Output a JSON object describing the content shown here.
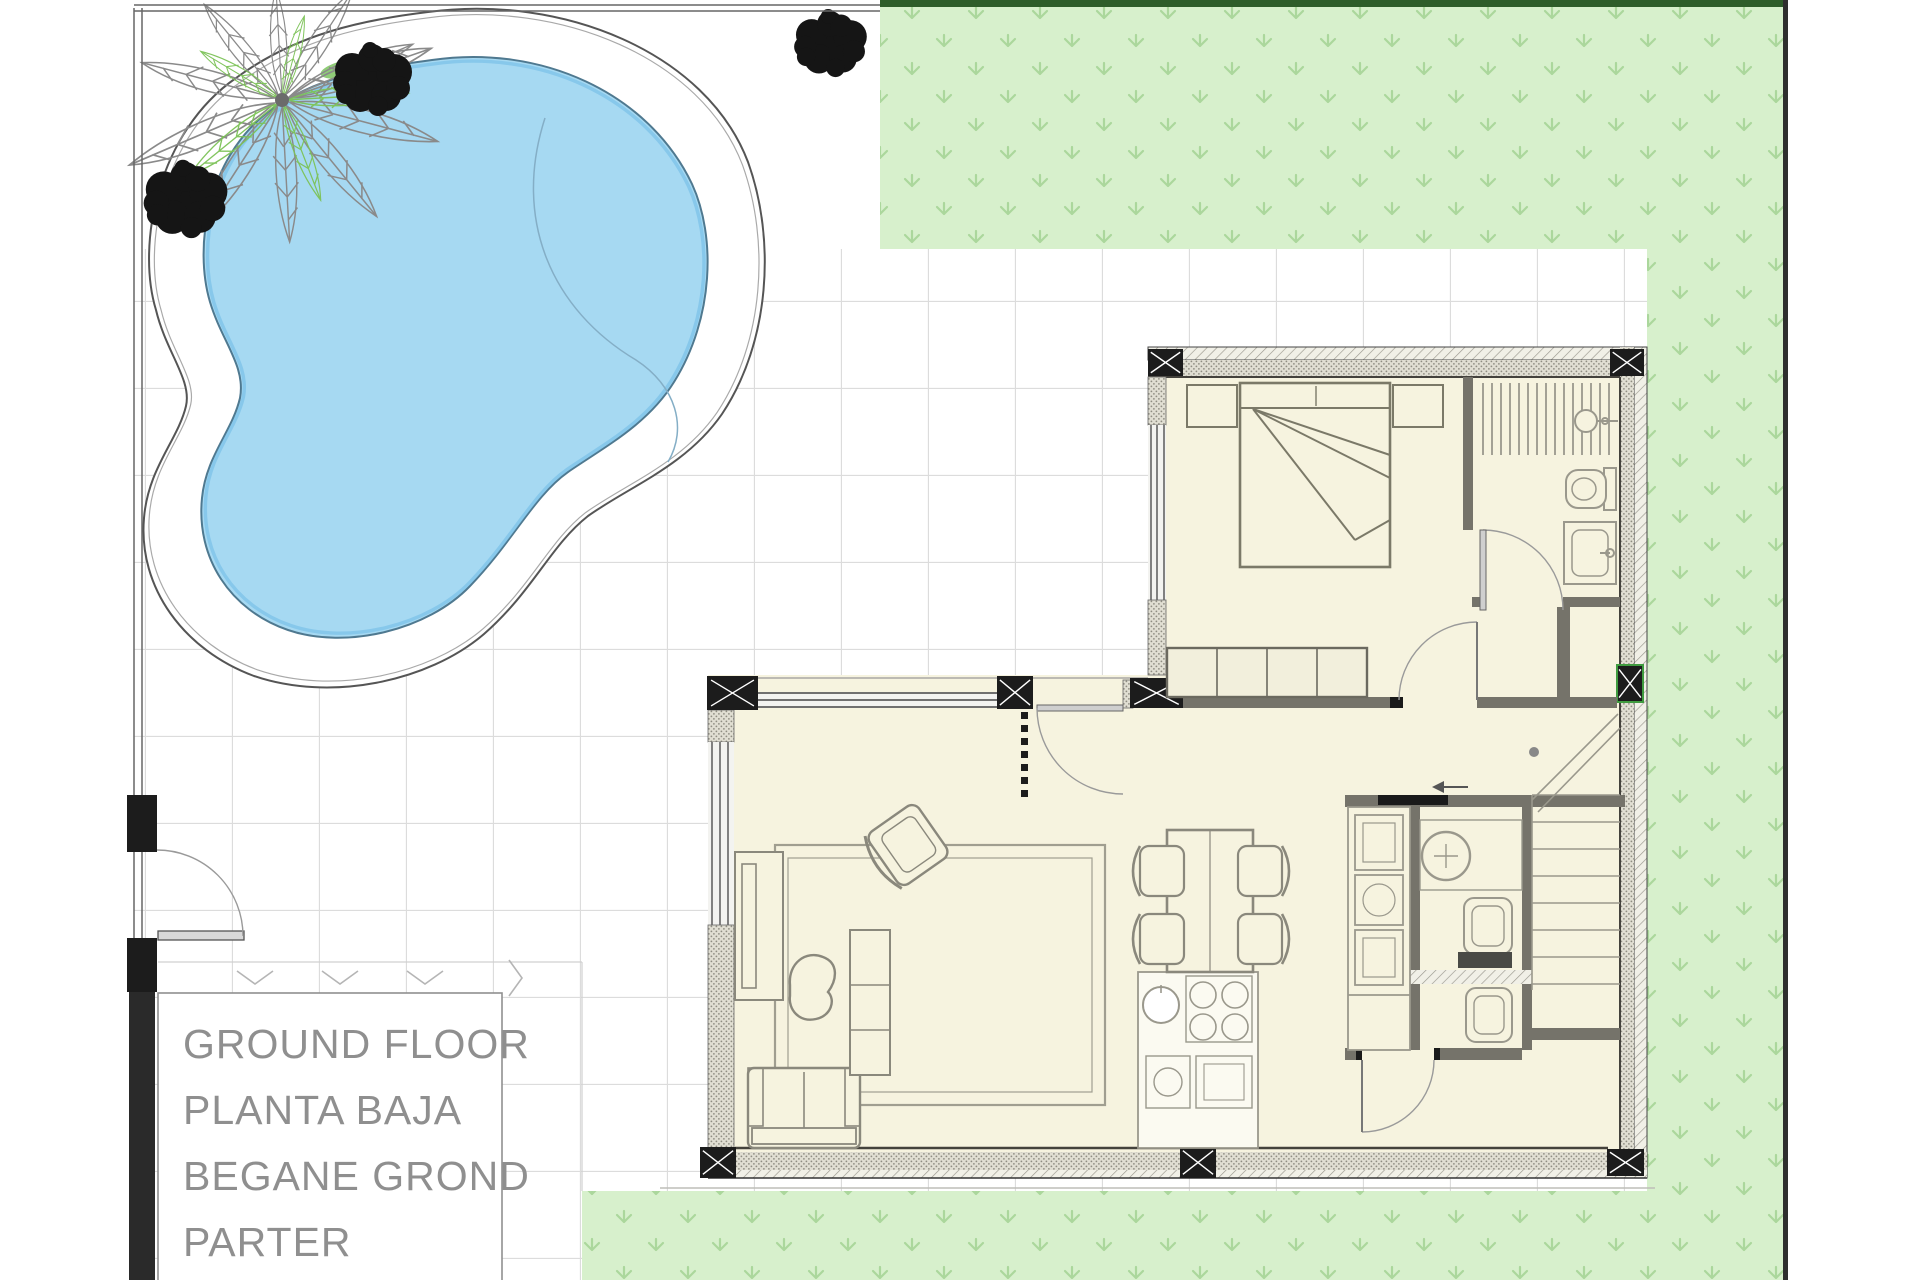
{
  "document": {
    "kind": "architectural-site-and-ground-floor-plan"
  },
  "title_block": {
    "lines": [
      "GROUND FLOOR",
      "PLANTA BAJA",
      "BEGANE GROND",
      "PARTER"
    ]
  },
  "palette": {
    "pool_water": "#a6d9f2",
    "pool_water_edge": "#4f7990",
    "pool_shallow_rim": "#7cc2e8",
    "grass": "#d7f0cc",
    "grass_tuft": "#abd79c",
    "grass_border_top": "#2e5d2a",
    "paving_grid_line": "#dcdcdc",
    "floor_cream": "#f6f3df",
    "structure_black": "#1c1c1c",
    "interior_wall": "#75736a",
    "furniture_line": "#8a887c",
    "label_text": "#8f8f8f",
    "vegetation_black": "#151515",
    "palm_gray": "#8a8a8a",
    "palm_green": "#7cc257"
  },
  "features": [
    "swimming-pool",
    "pool-deck",
    "palm-tree",
    "bushes",
    "lawn",
    "tiled-paving",
    "boundary-wall",
    "entrance-gate",
    "bedroom",
    "bed",
    "nightstands",
    "wardrobe",
    "bathroom",
    "shower",
    "toilet",
    "washbasin",
    "hallway",
    "stairs",
    "living-room",
    "rug",
    "sofa",
    "armchair",
    "coffee-table",
    "tv-unit",
    "sideboard",
    "dining-table",
    "dining-chairs",
    "kitchen-island",
    "cooktop",
    "kitchen-sink",
    "utility-cabinets",
    "wc",
    "structural-columns",
    "door-swings"
  ]
}
